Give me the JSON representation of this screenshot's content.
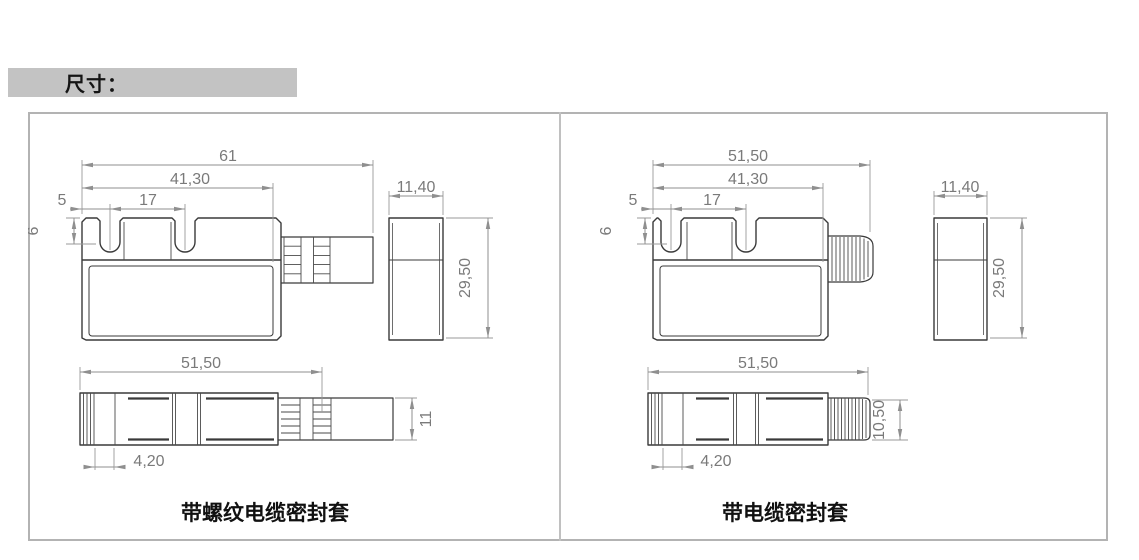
{
  "header": {
    "title": "尺寸："
  },
  "panels": [
    {
      "caption": "带螺纹电缆密封套",
      "front": {
        "total": "61",
        "inner": "41,30",
        "notch": "17",
        "offset": "5",
        "depth": "6",
        "side_w": "11,40",
        "height": "29,50"
      },
      "top": {
        "length": "51,50",
        "offset": "4,20",
        "conn": "11"
      }
    },
    {
      "caption": "带电缆密封套",
      "front": {
        "total": "51,50",
        "inner": "41,30",
        "notch": "17",
        "offset": "5",
        "depth": "6",
        "side_w": "11,40",
        "height": "29,50"
      },
      "top": {
        "length": "51,50",
        "offset": "4,20",
        "conn": "10,50"
      }
    }
  ],
  "colors": {
    "outline": "#3a3a3a",
    "dimension": "#8f8f8f",
    "panel_border": "#b3b3b3",
    "header_bg": "#c3c3c3"
  }
}
